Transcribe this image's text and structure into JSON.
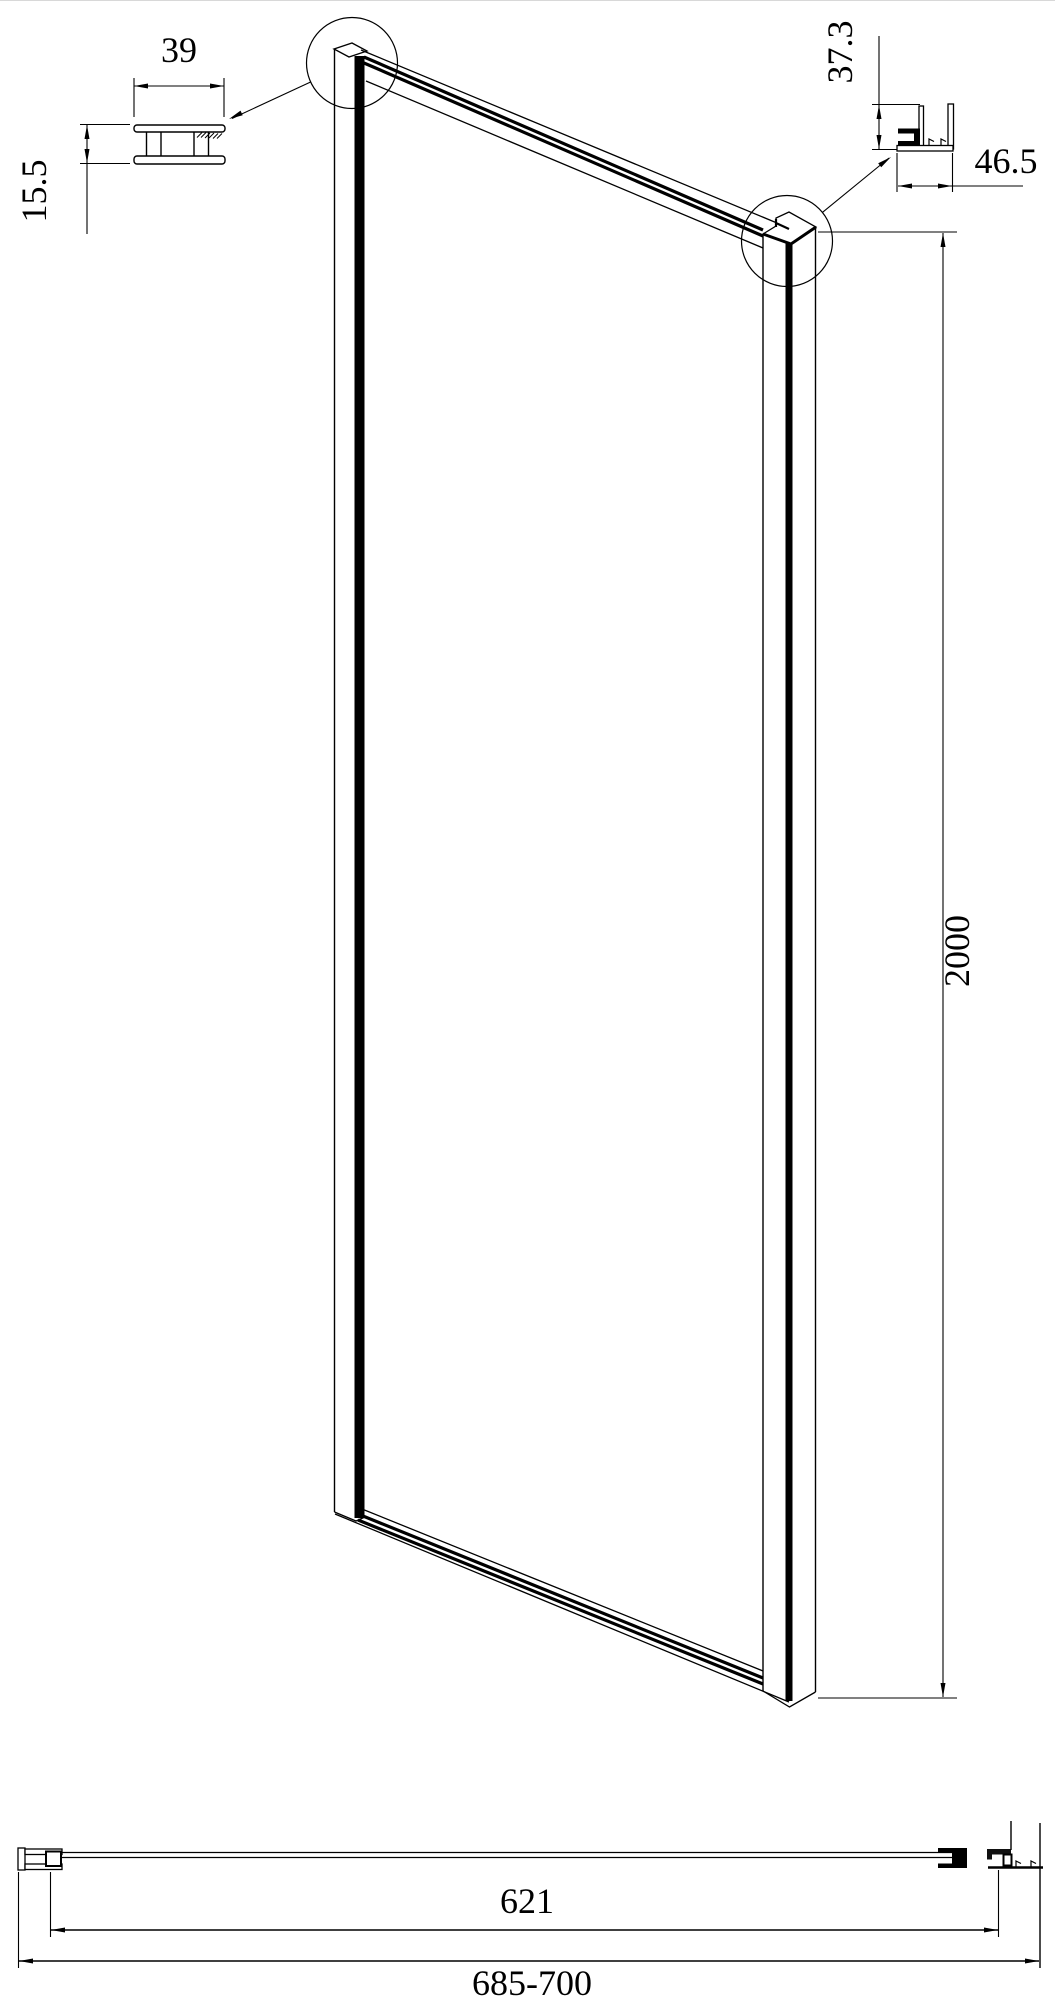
{
  "drawing": {
    "type": "technical-cad-drawing",
    "subject": "shower-side-panel",
    "background_color": "#ffffff",
    "line_color": "#000000",
    "views": {
      "glass_channel_detail": {
        "description": "top-left profile cross-section detail",
        "width_label": "39",
        "height_label": "15.5"
      },
      "wall_profile_detail": {
        "description": "top-right wall profile cross-section detail",
        "height_label": "37.3",
        "width_label": "46.5"
      },
      "panel_isometric": {
        "description": "main isometric view of framed glass panel",
        "height_label": "2000"
      },
      "plan_section": {
        "description": "bottom horizontal plan section",
        "glass_width_label": "621",
        "overall_width_label": "685-700"
      }
    }
  }
}
